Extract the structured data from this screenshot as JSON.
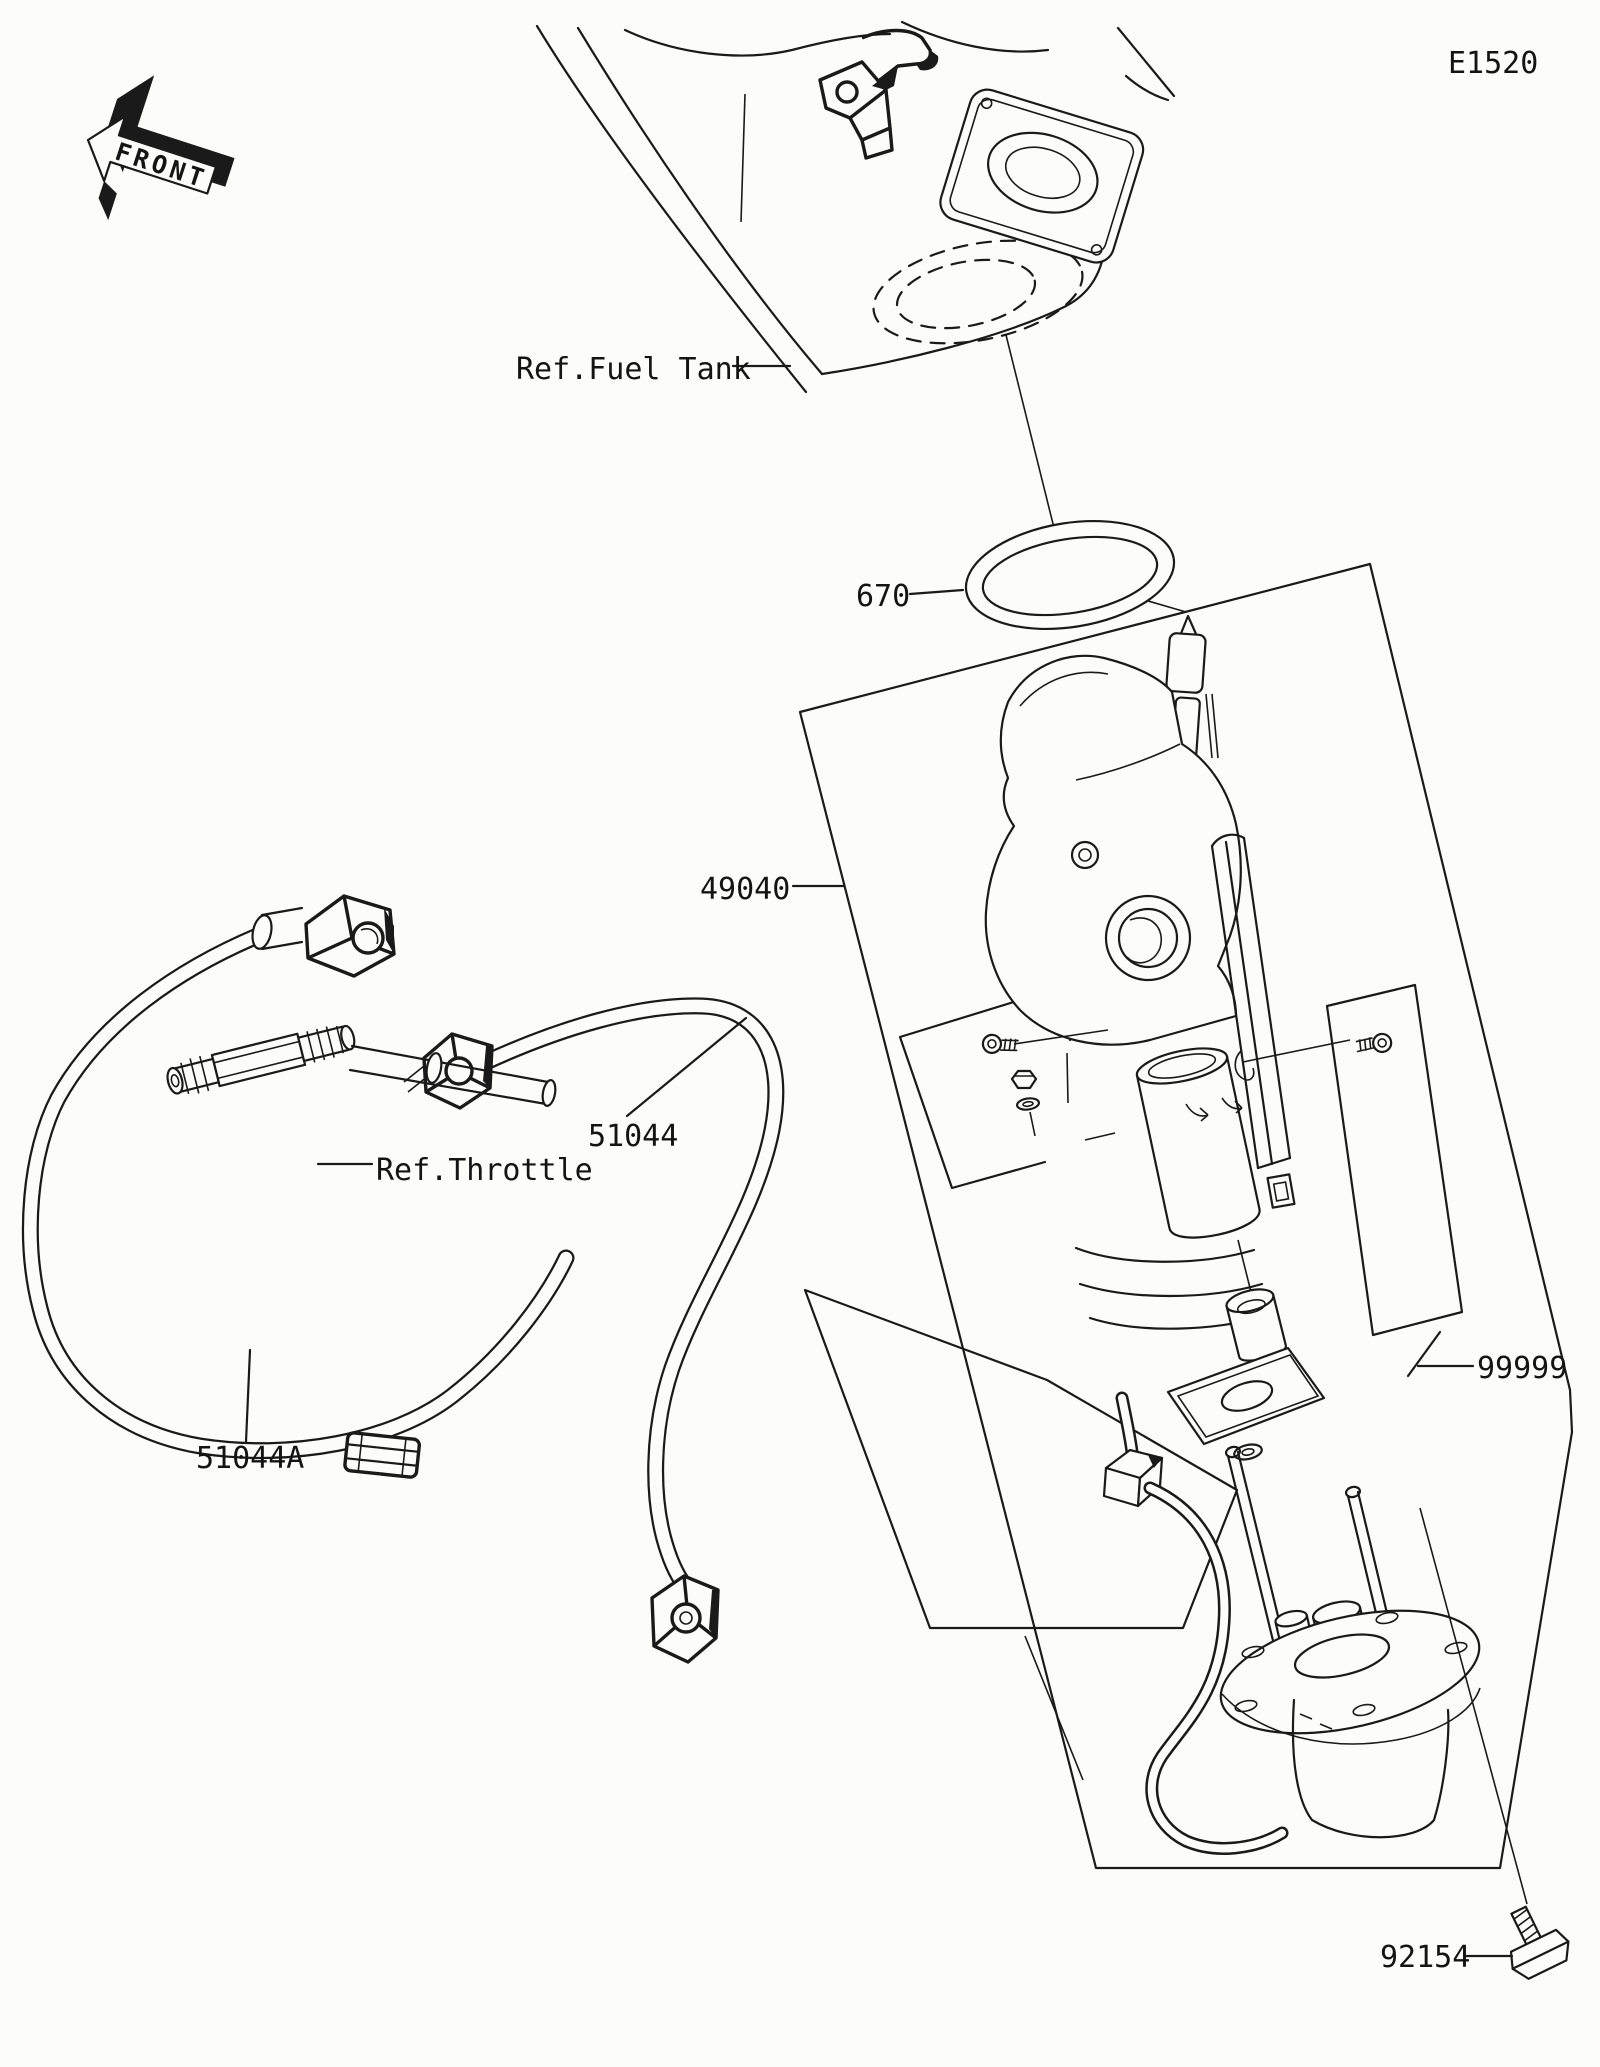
{
  "diagram": {
    "page_code": "E1520",
    "front_marker": "FRONT",
    "references": {
      "fuel_tank": "Ref.Fuel Tank",
      "throttle": "Ref.Throttle"
    },
    "parts": {
      "gasket": {
        "number": "670"
      },
      "fuel_pump": {
        "number": "49040"
      },
      "hose": {
        "number": "51044"
      },
      "hose_a": {
        "number": "51044A"
      },
      "misc_kit": {
        "number": "99999"
      },
      "bolt": {
        "number": "92154"
      }
    },
    "colors": {
      "line": "#1a1a1a",
      "background": "#fcfcfa"
    }
  }
}
